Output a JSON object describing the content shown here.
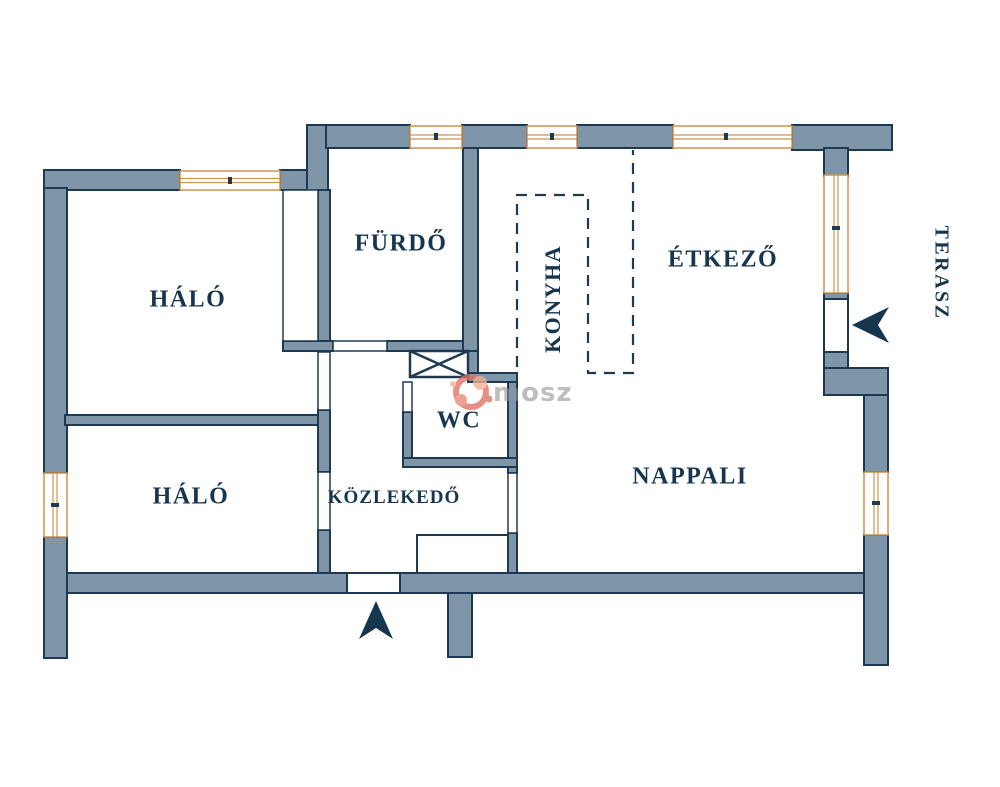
{
  "title": "apartment floor plan",
  "rooms": [
    {
      "id": "halo1",
      "label": "HÁLÓ",
      "orientation": "horizontal"
    },
    {
      "id": "furdo",
      "label": "FÜRDŐ",
      "orientation": "horizontal"
    },
    {
      "id": "konyha",
      "label": "KONYHA",
      "orientation": "vertical-reads-upward"
    },
    {
      "id": "etkezo",
      "label": "ÉTKEZŐ",
      "orientation": "horizontal"
    },
    {
      "id": "terasz",
      "label": "TERASZ",
      "orientation": "vertical-reads-downward"
    },
    {
      "id": "halo2",
      "label": "HÁLÓ",
      "orientation": "horizontal"
    },
    {
      "id": "kozlekedo",
      "label": "KÖZLEKEDŐ",
      "orientation": "horizontal"
    },
    {
      "id": "wc",
      "label": "WC",
      "orientation": "horizontal"
    },
    {
      "id": "nappali",
      "label": "NAPPALI",
      "orientation": "horizontal"
    }
  ],
  "markers": {
    "entrance_arrow": "points up into entrance door on bottom wall",
    "terrace_arrow": "points left into terrace door on right wall",
    "shaft_symbol": "crossed box (duct/shaft) between bathroom and WC",
    "kitchen_boundary": "dashed open-plan kitchen zone"
  },
  "watermark": {
    "text": "mosz",
    "logo": "red-salmon circular swirl logo"
  },
  "colors": {
    "background": "#ffffff",
    "wall_fill": "#7e96a8",
    "wall_outline": "#1e3a52",
    "window_frame": "#d0924f",
    "label_text": "#16354f",
    "arrow": "#16354f",
    "watermark_text": "#949494",
    "watermark_logo": "#dd7263"
  }
}
